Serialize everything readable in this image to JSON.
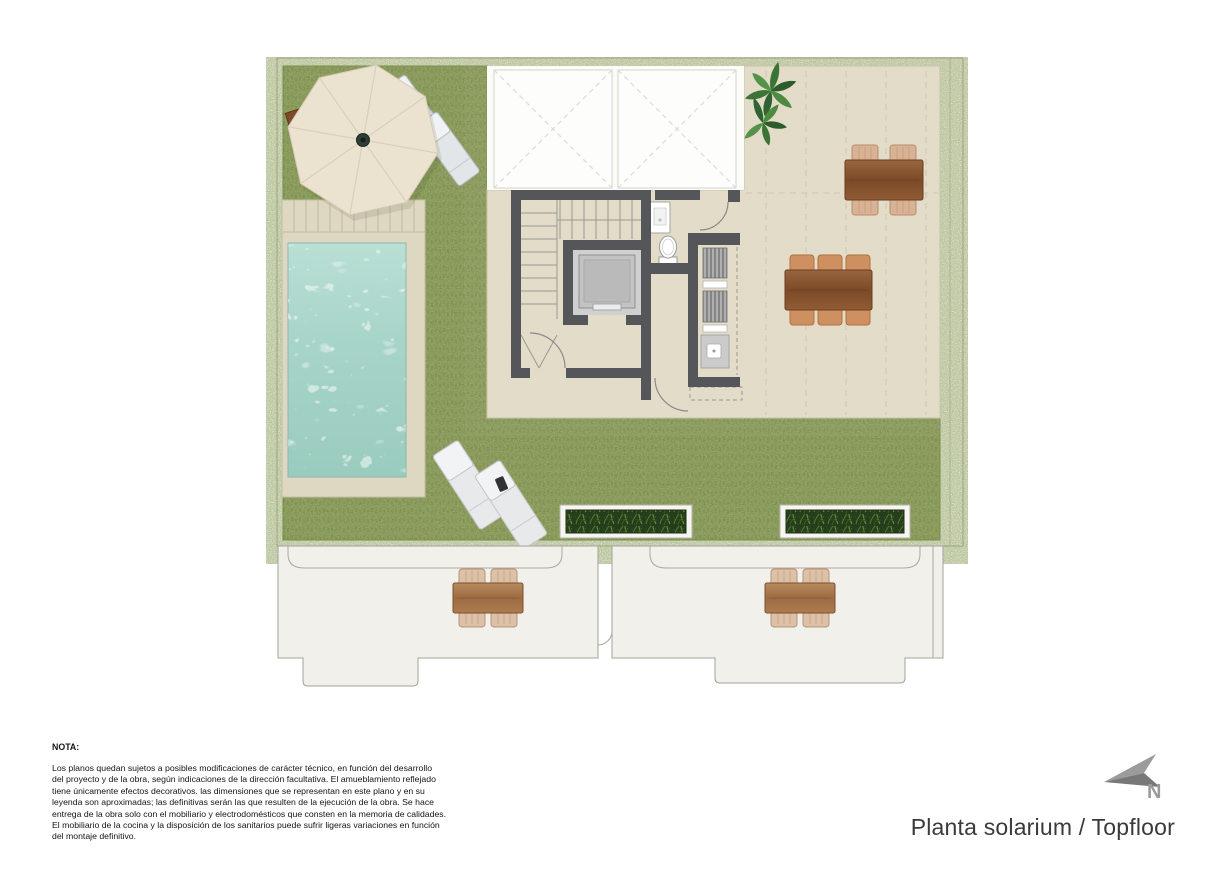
{
  "plan": {
    "title": "Planta solarium / Topfloor",
    "north_label": "N",
    "colors": {
      "grass": "#87975a",
      "grass_edge": "#7c8c50",
      "terrace": "#e4decb",
      "pool_deck": "#ded7c1",
      "pool_water": "#a9d5c9",
      "walls": "#54565a",
      "skylight": "#fdfdfc",
      "lower_terrace": "#f2f0ea",
      "wood_table": "#8a5a33",
      "wood_table_light": "#a5714a",
      "chair_wicker": "#d8b294",
      "chair_orange": "#cf9061",
      "parasol": "#ebe2cf",
      "lounger": "#e3e6e8",
      "elevator_cab": "#c3c3c3",
      "planter_foliage": "#263d1c",
      "north_arrow": "#8d8d8d"
    },
    "elements": [
      "grass-lawn",
      "swimming-pool",
      "pool-deck",
      "parasol",
      "parasol-base-table",
      "sun-loungers",
      "skylight-panels",
      "staircase",
      "elevator",
      "toilet",
      "washbasin-cabinet",
      "utility-closet",
      "louvre-units",
      "utility-sink",
      "plant",
      "dining-table-4-seats",
      "dining-table-6-seats",
      "planters",
      "lower-terrace-tables"
    ]
  },
  "note": {
    "heading": "NOTA:",
    "lines": [
      "Los planos quedan sujetos a posibles modificaciones de carácter técnico, en función del desarrollo",
      "del proyecto y de la obra, según indicaciones de la dirección facultativa. El amueblamiento reflejado",
      "tiene únicamente efectos decorativos. las dimensiones que se representan en este plano y en su",
      "leyenda son aproximadas; las definitivas serán las que resulten de la ejecución de la obra. Se hace",
      "entrega de la obra solo con el mobiliario y electrodomésticos que consten en la memoria de calidades.",
      "El mobiliario de la cocina y la disposición de los sanitarios puede sufrir ligeras variaciones en función",
      "del montaje definitivo."
    ]
  }
}
